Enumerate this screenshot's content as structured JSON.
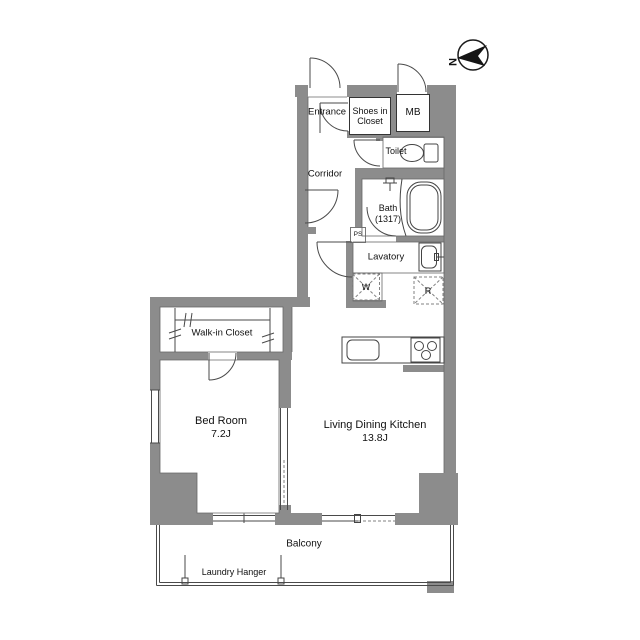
{
  "title": "apartment-floor-plan",
  "colors": {
    "wall": "#8c8c8c",
    "line": "#4a4a4a",
    "text": "#111111"
  },
  "compass": {
    "north_label": "N"
  },
  "rooms": {
    "entrance": {
      "label": "Entrance"
    },
    "shoes_in_closet": {
      "line1": "Shoes in",
      "line2": "Closet"
    },
    "meter_box": {
      "label": "MB"
    },
    "toilet": {
      "label": "Toilet"
    },
    "corridor": {
      "label": "Corridor"
    },
    "bath": {
      "label": "Bath",
      "size": "(1317)"
    },
    "lavatory": {
      "label": "Lavatory"
    },
    "pipe_space": {
      "label": "PS"
    },
    "washer": {
      "label": "W"
    },
    "refrigerator": {
      "label": "R"
    },
    "walk_in_closet": {
      "label": "Walk-in Closet"
    },
    "bedroom": {
      "label": "Bed Room",
      "size": "7.2J"
    },
    "living_dining_kitchen": {
      "label": "Living Dining Kitchen",
      "size": "13.8J"
    },
    "balcony": {
      "label": "Balcony"
    },
    "laundry_hanger": {
      "label": "Laundry Hanger"
    }
  }
}
